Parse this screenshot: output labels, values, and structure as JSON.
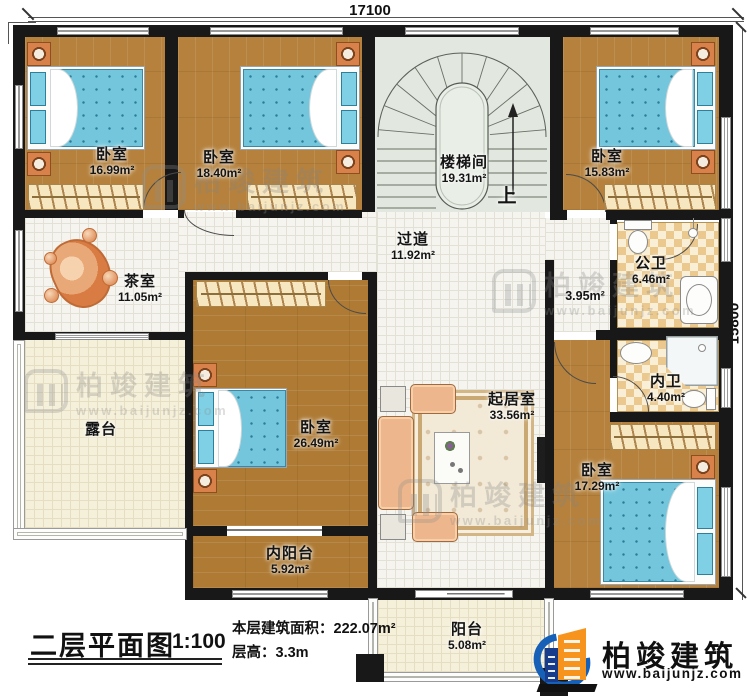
{
  "dimensions": {
    "width_top": "17100",
    "height_right": "15800"
  },
  "rooms": {
    "bedroom1": {
      "name": "卧室",
      "area": "16.99m²"
    },
    "bedroom2": {
      "name": "卧室",
      "area": "18.40m²"
    },
    "stairwell": {
      "name": "楼梯间",
      "area": "19.31m²",
      "up": "上"
    },
    "bedroom3": {
      "name": "卧室",
      "area": "15.83m²"
    },
    "tea_room": {
      "name": "茶室",
      "area": "11.05m²"
    },
    "hallway": {
      "name": "过道",
      "area": "11.92m²"
    },
    "nook": {
      "area": "3.95m²"
    },
    "public_bath": {
      "name": "公卫",
      "area": "6.46m²"
    },
    "inner_bath": {
      "name": "内卫",
      "area": "4.40m²"
    },
    "bedroom4": {
      "name": "卧室",
      "area": "26.49m²"
    },
    "living_room": {
      "name": "起居室",
      "area": "33.56m²"
    },
    "bedroom5": {
      "name": "卧室",
      "area": "17.29m²"
    },
    "terrace": {
      "name": "露台"
    },
    "inner_balcony": {
      "name": "内阳台",
      "area": "5.92m²"
    },
    "balcony": {
      "name": "阳台",
      "area": "5.08m²"
    }
  },
  "title": {
    "name": "二层平面图",
    "scale": "1:100",
    "area_line": "本层建筑面积：222.07m²",
    "height_line": "层高：3.3m"
  },
  "brand": {
    "name": "柏竣建筑",
    "site": "www.baijunjz.com"
  },
  "watermark": {
    "name": "柏竣建筑",
    "site": "www.baijunjz.com"
  },
  "colors": {
    "wall": "#181818",
    "wood": "#b5813c",
    "tile": "#f5f4ee",
    "stairs": "#e2e8df",
    "bath_checker": "#eac88e",
    "terrace": "#f5f0da",
    "bed": "#74c6dc",
    "furniture_orange": "#d8814a",
    "brand_blue": "#1660b8",
    "brand_orange": "#f7941e"
  }
}
